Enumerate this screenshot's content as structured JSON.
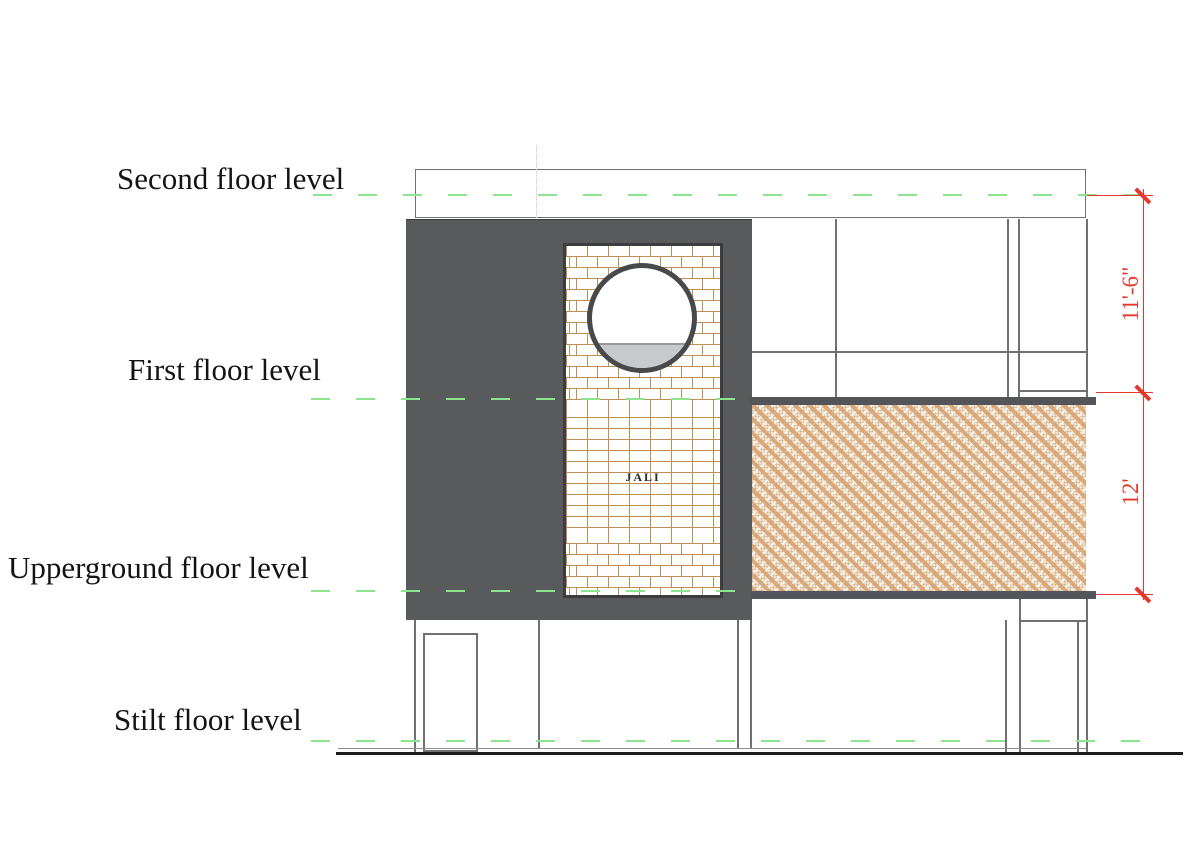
{
  "elevation": {
    "floor_levels": [
      {
        "label": "Second floor level"
      },
      {
        "label": "First floor level"
      },
      {
        "label": "Upperground floor level"
      },
      {
        "label": "Stilt floor level"
      }
    ],
    "dimensions": [
      {
        "label": "11'-6\""
      },
      {
        "label": "12'"
      }
    ],
    "annotations": {
      "jali_label": "JALI"
    },
    "colors": {
      "level_line_green": "#8ce48c",
      "dimension_red": "#e5372b",
      "facade_dark_gray": "#595a5c",
      "slab_dark_gray": "#54555a",
      "brick_mortar_tan": "#bf8e55",
      "rattan_tan": "#d9a97c",
      "outline_gray": "#707174"
    }
  }
}
